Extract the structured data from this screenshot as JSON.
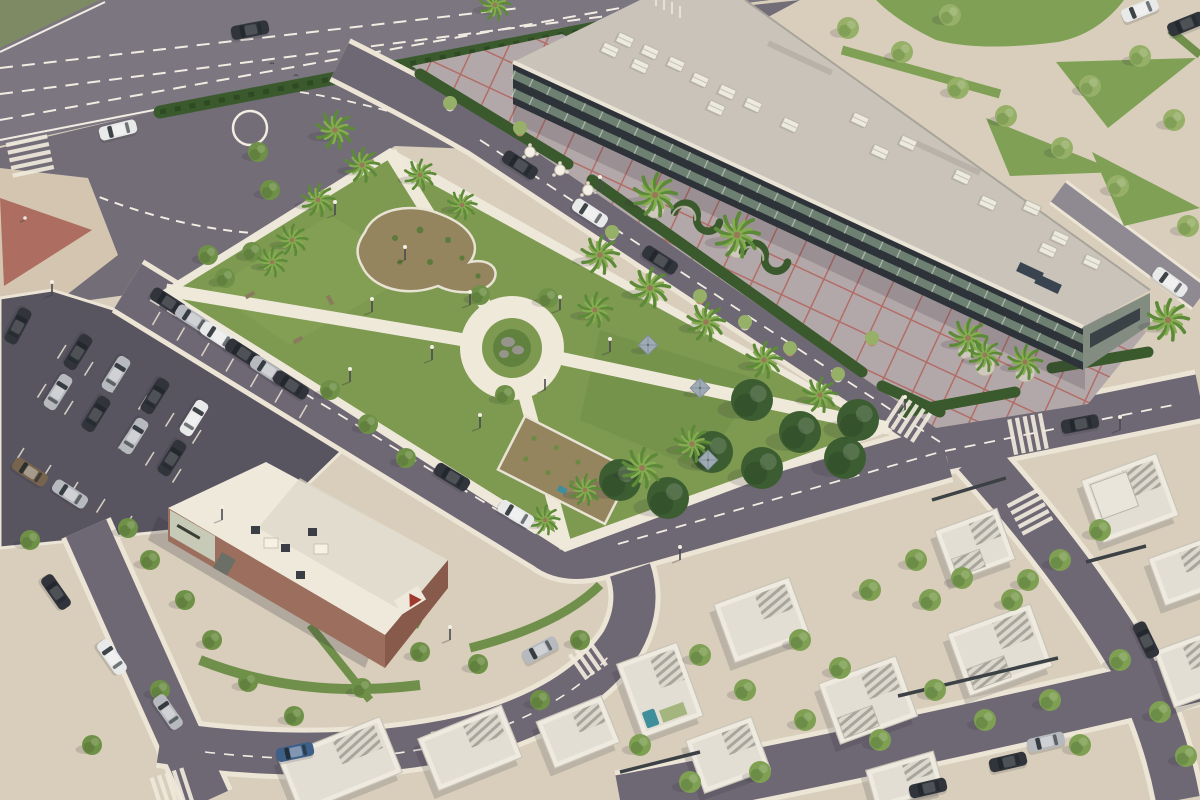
{
  "meta": {
    "title": "Aerial 3D render of a mixed-use development",
    "description": "Bird's-eye architectural rendering: highway and roundabout top-left, central palm park with circular plaza, long glass retail building with red-grid esplanade, parking lot with cars, brick restaurant pavilion, and white flat-roof villas with pools."
  },
  "palette": {
    "base": "#d8cebb",
    "plazaTL": "#d3c5b0",
    "plazaRed": "#ad6d60",
    "road": "#6e6874",
    "highway": "#7b7680",
    "junction": "#736d78",
    "parking": "#585460",
    "curb": "#ece5d6",
    "dash": "#f2ede2",
    "grass": "#7d9a50",
    "grassDark": "#65853f",
    "grassEsp": "#7fa055",
    "hedge": "#3a5a2d",
    "soil": "#94855f",
    "parkPath": "#efe9da",
    "tile": "#b3a8a9",
    "redline": "#b2635a",
    "roof": "#c9c3b9",
    "parapet": "#eae4d6",
    "facade": "#2d3339",
    "glazing": "#6e8072",
    "endwall": "#828c80",
    "brick": "#9c6e5d",
    "brickDark": "#875a4b",
    "sign": "#c6cab6",
    "white": "#f1ece0",
    "villaWall": "#efeae0",
    "villaRoof": "#e2ded4",
    "stripe": "#a7a49b",
    "pool": "#3f8e9b",
    "fence": "#3c4146",
    "shadow": "rgba(45,40,55,0.30)",
    "treeLight": "#97b068",
    "treeMid": "#6f9147",
    "treeDark": "#3c5c31",
    "frond": "#5d8a39",
    "frondLight": "#85ac50",
    "trunk": "#997a58",
    "car": {
      "dark": "#31353b",
      "silver": "#b6b9bd",
      "white": "#e8e9e9",
      "blue": "#3e5f88",
      "brown": "#76644e"
    }
  },
  "scene": {
    "cars": [
      [
        250,
        30,
        -11,
        "dark"
      ],
      [
        118,
        130,
        -14,
        "white"
      ],
      [
        520,
        165,
        33,
        "dark"
      ],
      [
        590,
        213,
        33,
        "white"
      ],
      [
        660,
        260,
        33,
        "dark"
      ],
      [
        452,
        477,
        31,
        "dark"
      ],
      [
        516,
        514,
        31,
        "white"
      ],
      [
        168,
        302,
        33,
        "dark"
      ],
      [
        193,
        319,
        33,
        "silver"
      ],
      [
        218,
        336,
        33,
        "white"
      ],
      [
        243,
        353,
        33,
        "dark"
      ],
      [
        268,
        370,
        33,
        "silver"
      ],
      [
        291,
        385,
        33,
        "dark"
      ],
      [
        78,
        352,
        122,
        "dark"
      ],
      [
        116,
        374,
        122,
        "silver"
      ],
      [
        155,
        396,
        122,
        "dark"
      ],
      [
        194,
        418,
        122,
        "white"
      ],
      [
        58,
        392,
        122,
        "silver"
      ],
      [
        96,
        414,
        122,
        "dark"
      ],
      [
        134,
        436,
        122,
        "silver"
      ],
      [
        172,
        458,
        122,
        "dark"
      ],
      [
        18,
        326,
        118,
        "dark"
      ],
      [
        30,
        472,
        33,
        "brown"
      ],
      [
        70,
        494,
        33,
        "silver"
      ],
      [
        56,
        592,
        55,
        "dark"
      ],
      [
        112,
        657,
        55,
        "white"
      ],
      [
        168,
        712,
        55,
        "silver"
      ],
      [
        295,
        752,
        -12,
        "blue"
      ],
      [
        540,
        650,
        -28,
        "silver"
      ],
      [
        1080,
        424,
        -11,
        "dark"
      ],
      [
        1170,
        282,
        36,
        "white"
      ],
      [
        1146,
        640,
        64,
        "dark"
      ],
      [
        1008,
        762,
        -13,
        "dark"
      ],
      [
        1046,
        742,
        -13,
        "silver"
      ],
      [
        928,
        788,
        -13,
        "dark"
      ],
      [
        1140,
        10,
        -22,
        "white"
      ],
      [
        1186,
        24,
        -22,
        "dark"
      ]
    ],
    "palms": [
      [
        335,
        130,
        1.1
      ],
      [
        362,
        165,
        1.0
      ],
      [
        318,
        200,
        0.95
      ],
      [
        292,
        240,
        0.9
      ],
      [
        272,
        262,
        0.85
      ],
      [
        420,
        175,
        0.9
      ],
      [
        462,
        205,
        0.85
      ],
      [
        495,
        5,
        0.9
      ],
      [
        600,
        255,
        1.1
      ],
      [
        650,
        288,
        1.15
      ],
      [
        706,
        322,
        1.1
      ],
      [
        764,
        360,
        1.05
      ],
      [
        820,
        395,
        1.0
      ],
      [
        642,
        468,
        1.15
      ],
      [
        692,
        444,
        1.05
      ],
      [
        585,
        490,
        0.9
      ],
      [
        545,
        520,
        0.85
      ],
      [
        595,
        310,
        1.0
      ],
      [
        655,
        195,
        1.25
      ],
      [
        737,
        235,
        1.3
      ],
      [
        968,
        338,
        1.1
      ],
      [
        1025,
        362,
        1.0
      ],
      [
        1168,
        320,
        1.2
      ],
      [
        985,
        355,
        0.95
      ]
    ],
    "parkTreesDark": [
      [
        752,
        400
      ],
      [
        800,
        432
      ],
      [
        845,
        458
      ],
      [
        762,
        468
      ],
      [
        712,
        452
      ],
      [
        668,
        498
      ],
      [
        620,
        480
      ],
      [
        858,
        420
      ]
    ],
    "espTrees": [
      [
        848,
        28
      ],
      [
        902,
        52
      ],
      [
        958,
        88
      ],
      [
        1006,
        116
      ],
      [
        1062,
        148
      ],
      [
        1118,
        186
      ],
      [
        1174,
        120
      ],
      [
        1090,
        86
      ],
      [
        1140,
        56
      ],
      [
        1188,
        226
      ],
      [
        950,
        15
      ]
    ],
    "streetTrees": [
      [
        258,
        152
      ],
      [
        270,
        190
      ],
      [
        330,
        390
      ],
      [
        368,
        424
      ],
      [
        406,
        458
      ],
      [
        212,
        640
      ],
      [
        248,
        682
      ],
      [
        294,
        716
      ],
      [
        362,
        688
      ],
      [
        420,
        652
      ],
      [
        478,
        664
      ],
      [
        540,
        700
      ],
      [
        580,
        640
      ],
      [
        150,
        560
      ],
      [
        185,
        600
      ],
      [
        128,
        528
      ],
      [
        30,
        540
      ],
      [
        208,
        255
      ],
      [
        225,
        278
      ],
      [
        252,
        252
      ],
      [
        480,
        295
      ],
      [
        548,
        298
      ],
      [
        505,
        395
      ],
      [
        92,
        745
      ],
      [
        160,
        690
      ]
    ],
    "villaTrees": [
      [
        700,
        655
      ],
      [
        745,
        690
      ],
      [
        800,
        640
      ],
      [
        840,
        668
      ],
      [
        930,
        600
      ],
      [
        962,
        578
      ],
      [
        1012,
        600
      ],
      [
        1060,
        560
      ],
      [
        1100,
        530
      ],
      [
        935,
        690
      ],
      [
        985,
        720
      ],
      [
        1050,
        700
      ],
      [
        880,
        740
      ],
      [
        805,
        720
      ],
      [
        760,
        772
      ],
      [
        690,
        782
      ],
      [
        640,
        745
      ],
      [
        1120,
        660
      ],
      [
        1160,
        712
      ],
      [
        1186,
        756
      ],
      [
        870,
        590
      ],
      [
        916,
        560
      ],
      [
        1080,
        745
      ],
      [
        1028,
        580
      ]
    ],
    "lamps": [
      [
        52,
        295
      ],
      [
        350,
        382
      ],
      [
        222,
        520
      ],
      [
        450,
        640
      ],
      [
        680,
        560
      ],
      [
        905,
        410
      ],
      [
        1120,
        430
      ],
      [
        600,
        190
      ],
      [
        335,
        215
      ],
      [
        405,
        260
      ],
      [
        470,
        305
      ],
      [
        545,
        390
      ],
      [
        432,
        360
      ],
      [
        372,
        312
      ],
      [
        560,
        310
      ],
      [
        610,
        352
      ],
      [
        480,
        428
      ]
    ],
    "umbrellas": [
      [
        648,
        345
      ],
      [
        700,
        388
      ],
      [
        708,
        460
      ]
    ],
    "tables": [
      [
        530,
        152
      ],
      [
        560,
        170
      ],
      [
        588,
        190
      ]
    ],
    "benches": [
      [
        250,
        295,
        -30
      ],
      [
        298,
        340,
        -30
      ],
      [
        330,
        300,
        60
      ]
    ],
    "hvac": [
      [
        625,
        40
      ],
      [
        650,
        52
      ],
      [
        676,
        64
      ],
      [
        640,
        66
      ],
      [
        610,
        50
      ],
      [
        700,
        80
      ],
      [
        727,
        92
      ],
      [
        753,
        105
      ],
      [
        716,
        108
      ],
      [
        790,
        125
      ],
      [
        860,
        120
      ],
      [
        880,
        152
      ],
      [
        908,
        143
      ],
      [
        962,
        177
      ],
      [
        988,
        203
      ],
      [
        1032,
        208
      ],
      [
        1060,
        238
      ],
      [
        1092,
        262
      ],
      [
        1048,
        250
      ]
    ],
    "roofPanels": [
      [
        1030,
        272
      ],
      [
        1048,
        284
      ]
    ],
    "skylights": [
      [
        800,
        58
      ],
      [
        948,
        158
      ]
    ],
    "villas": [
      [
        660,
        690,
        -20,
        64,
        78,
        "pool"
      ],
      [
        762,
        620,
        -20,
        80,
        62,
        ""
      ],
      [
        868,
        700,
        -20,
        82,
        64,
        "pergola"
      ],
      [
        728,
        755,
        -20,
        70,
        56,
        ""
      ],
      [
        975,
        545,
        -20,
        66,
        54,
        "pergola"
      ],
      [
        1000,
        650,
        -20,
        88,
        66,
        "pergola"
      ],
      [
        1130,
        498,
        -20,
        80,
        66,
        "two"
      ],
      [
        1185,
        572,
        -20,
        60,
        50,
        ""
      ],
      [
        340,
        765,
        -22,
        110,
        60,
        ""
      ],
      [
        470,
        748,
        -22,
        90,
        56,
        ""
      ],
      [
        578,
        732,
        -22,
        70,
        50,
        ""
      ],
      [
        1190,
        670,
        -20,
        55,
        60,
        ""
      ],
      [
        905,
        780,
        -16,
        70,
        40,
        ""
      ]
    ],
    "fences": [
      [
        898,
        696,
        1058,
        658
      ],
      [
        620,
        772,
        700,
        752
      ],
      [
        1086,
        562,
        1146,
        546
      ],
      [
        932,
        500,
        1006,
        478
      ]
    ],
    "zebras": [
      [
        30,
        156,
        78,
        5,
        42
      ],
      [
        455,
        745,
        -10,
        6,
        34
      ],
      [
        588,
        660,
        -35,
        4,
        30
      ],
      [
        908,
        419,
        33,
        5,
        34
      ],
      [
        1028,
        434,
        -11,
        5,
        36
      ],
      [
        1030,
        512,
        62,
        5,
        34
      ],
      [
        172,
        790,
        -18,
        5,
        36
      ]
    ],
    "parkingRows": [
      [
        160,
        312,
        24.5,
        15.5,
        7,
        15,
        120
      ],
      [
        66,
        345,
        27,
        17,
        6,
        16,
        122
      ],
      [
        46,
        384,
        27,
        17,
        6,
        16,
        122
      ],
      [
        24,
        448,
        27,
        17,
        5,
        16,
        122
      ]
    ],
    "planters": [
      [
        655,
        208
      ],
      [
        737,
        248
      ],
      [
        968,
        350
      ],
      [
        1025,
        372
      ],
      [
        985,
        366
      ]
    ],
    "pots": [
      [
        450,
        103
      ],
      [
        520,
        128
      ],
      [
        612,
        232
      ],
      [
        700,
        296
      ],
      [
        745,
        322
      ],
      [
        790,
        348
      ],
      [
        838,
        374
      ],
      [
        872,
        338
      ]
    ],
    "sHedges": [
      [
        700,
        212,
        30
      ],
      [
        768,
        252,
        30
      ]
    ],
    "flagpoles": [
      [
        656,
        6
      ],
      [
        664,
        10
      ],
      [
        672,
        14
      ],
      [
        680,
        18
      ]
    ],
    "birds": [
      [
        272,
        64
      ],
      [
        296,
        76
      ]
    ],
    "person": [
      25,
      218
    ]
  }
}
